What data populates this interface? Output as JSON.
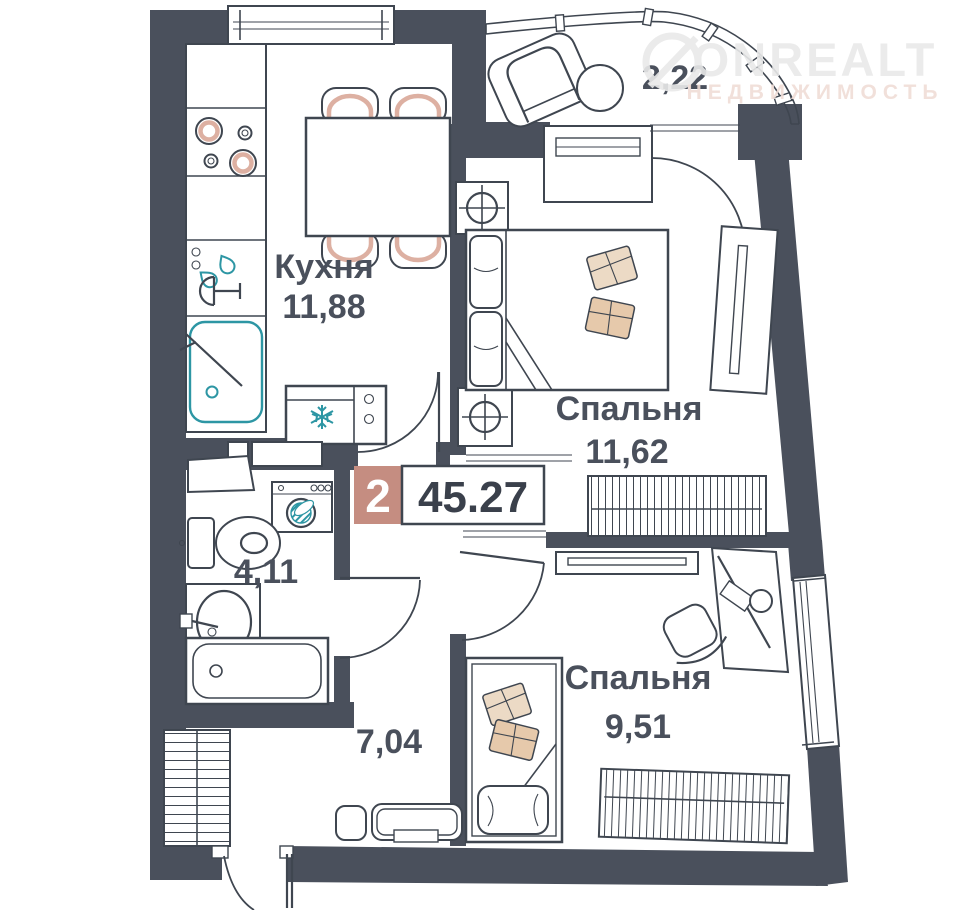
{
  "plan": {
    "badge": {
      "rooms_count": "2",
      "total_area": "45.27"
    },
    "rooms": {
      "kitchen": {
        "name": "Кухня",
        "area": "11,88"
      },
      "bedroom1": {
        "name": "Спальня",
        "area": "11,62"
      },
      "bedroom2": {
        "name": "Спальня",
        "area": "9,51"
      },
      "bathroom": {
        "area": "4,11"
      },
      "hallway": {
        "area": "7,04"
      },
      "balcony": {
        "area": "2,22"
      }
    },
    "watermark": {
      "brand": "ONREALT",
      "tagline": "НЕДВИЖИМОСТЬ"
    },
    "fixtures": {
      "kitchen": [
        "stove",
        "prep-sink",
        "sink",
        "dining-table",
        "chairs",
        "fridge"
      ],
      "bedroom1": [
        "double-bed",
        "nightstands",
        "lamps",
        "wardrobe",
        "radiator",
        "balcony-door"
      ],
      "bedroom2": [
        "single-bed",
        "desk",
        "desk-chair",
        "shelf",
        "wardrobe",
        "window"
      ],
      "bathroom": [
        "toilet",
        "washbasin",
        "bathtub",
        "washing-machine",
        "shelf"
      ],
      "hallway": [
        "wardrobe",
        "bench",
        "pouf",
        "entrance-door"
      ],
      "balcony": [
        "armchair",
        "side-table",
        "glazing"
      ]
    },
    "colors": {
      "wall": "#4a505c",
      "outline": "#3f4650",
      "label_text": "#4a505c",
      "badge_pink": "#c58d81",
      "accent_pink": "#ddb0a2",
      "teal": "#2d96a4",
      "pillow_beige": "#ecdac5",
      "pillow_tan": "#e6c9ab",
      "watermark_gray": "#e9e9e9",
      "watermark_pink": "#f0ddd7"
    }
  }
}
